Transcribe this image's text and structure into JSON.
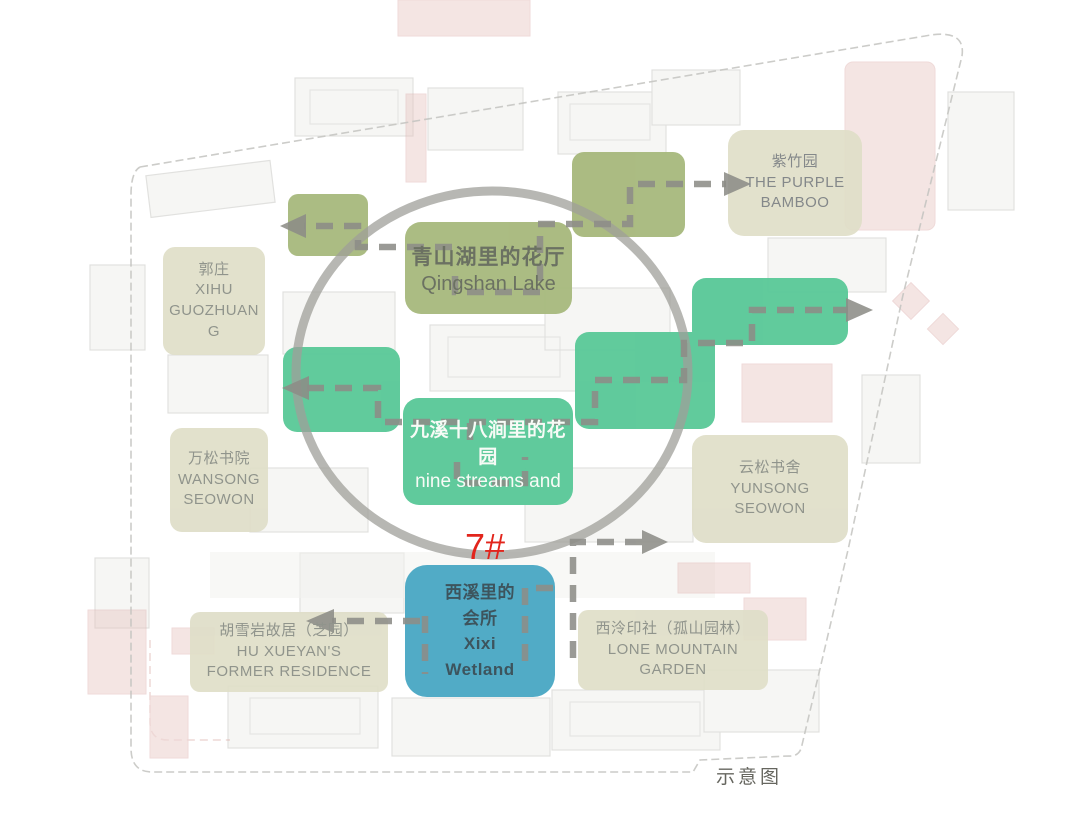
{
  "caption": {
    "label": "示意图"
  },
  "marker": {
    "label": "7#"
  },
  "blocks": {
    "purple_bamboo": {
      "cn": "紫竹园",
      "en": "THE PURPLE\nBAMBOO"
    },
    "qingshan": {
      "cn": "青山湖里的花厅",
      "en": "Qingshan Lake"
    },
    "guozhuang": {
      "cn": "郭庄",
      "en": "XIHU\nGUOZHUAN\nG"
    },
    "nine_streams": {
      "cn": "九溪十八涧里的花园",
      "en": "nine streams and"
    },
    "wansong": {
      "cn": "万松书院",
      "en": "WANSONG\nSEOWON"
    },
    "yunsong": {
      "cn": "云松书舍",
      "en": "YUNSONG\nSEOWON"
    },
    "xixi": {
      "cn": "西溪里的\n会所",
      "en": "Xixi\nWetland"
    },
    "hu_xueyan": {
      "cn": "胡雪岩故居（芝园）",
      "en": "HU XUEYAN'S\nFORMER RESIDENCE"
    },
    "lone_mountain": {
      "cn": "西泠印社（孤山园林）",
      "en": "LONE MOUNTAIN\nGARDEN"
    }
  },
  "colors": {
    "olive_block": "#a7b87c",
    "mint_block": "#58c897",
    "beige_block": "#dfdec8",
    "blue_block": "#48a6c3",
    "marker_red": "#e2251c",
    "route_dash_gray": "#8d8d88",
    "circle_gray": "#9f9f9a",
    "boundary_gray": "#c3c3bf"
  }
}
